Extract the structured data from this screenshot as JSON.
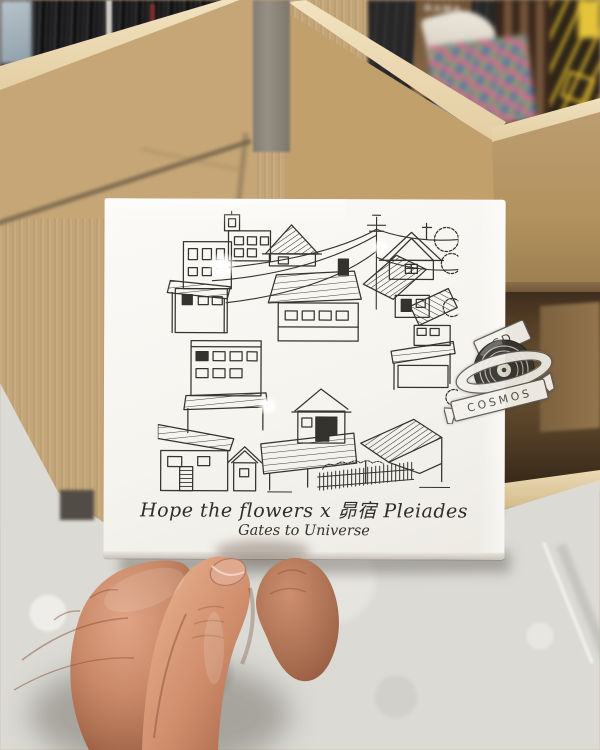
{
  "photo": {
    "cd": {
      "title": "Hope the flowers x 昴宿 Pleiades",
      "subtitle": "Gates to Universe"
    },
    "watermark": {
      "top": "CD",
      "bottom": "COSMOS"
    },
    "background": {
      "album_spine_text": "RAMA"
    },
    "colors": {
      "wood": "#c4a577",
      "wood_edge_highlight": "#f2e2c0",
      "bin_interior": "#54402c",
      "concrete_pillar": "#8d867c",
      "floor_terrazzo": "#dbdad5",
      "cd_white": "#f8f6f2",
      "illustration_ink": "#35332d",
      "skin_light": "#e5a987",
      "skin_mid": "#c07a5e",
      "skin_shadow": "#8e563e"
    }
  }
}
